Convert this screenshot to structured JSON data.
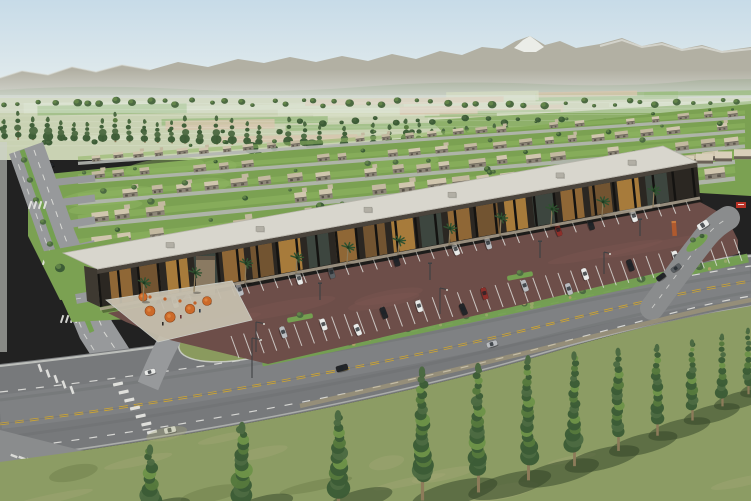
{
  "meta": {
    "title": "Aerial rendering of master-planned community",
    "description": "Photorealistic aerial 3D rendering of a desert-valley master-planned community: rows of flat-roofed single-story homes with lawns and trees, a single-story retail strip with covered walkway, palm trees and orange cafe umbrellas, an angled surface parking lot with cars, a curving arterial road with double-yellow centerline and crosswalks, a foreground lawn with a receding row of poplar trees, farm fields and a snow-capped mountain range in the distance under a hazy blue sky."
  },
  "palette": {
    "sky_top": "#c7dbe8",
    "sky_horizon": "#ecf1ee",
    "haze": "#e8edea",
    "mountain_far": "#b2b0a3",
    "snow": "#eef0ec",
    "foothill": "#9aa48d",
    "field_base": "#c9d2b3",
    "field_green": "#9cbd82",
    "field_pale": "#d5dcc2",
    "field_tan": "#d8c6ae",
    "field_bright": "#86ab61",
    "tree_dark": "#3c5c36",
    "tree_mid": "#4c6a42",
    "tree_light": "#6b8f4c",
    "trunk": "#8d7b5a",
    "lawn": "#7ba152",
    "lawn_light": "#8fb562",
    "street_minor": "#b4b7b2",
    "house_wall": "#8d8678",
    "house_roof_a": "#d0c6ae",
    "house_roof_b": "#c3b9a0",
    "house_edge": "#6e675c",
    "road": "#77797b",
    "road_light": "#8a8c8d",
    "road_pale": "#97999b",
    "sidewalk": "#cdd0ca",
    "lane_yellow": "#d2a62f",
    "lane_white": "#e8e8e4",
    "strip_roof": "#d8d6cd",
    "strip_fascia": "#4a443c",
    "strip_dark": "#2b2722",
    "post": "#141311",
    "storefront_a": "#9a6f38",
    "storefront_b": "#b5853e",
    "storefront_c": "#7a5a33",
    "tower": "#8a7a62",
    "plaza": "#c6bfae",
    "umbrella": "#cc6a2a",
    "palm": "#2f5230",
    "parking": "#6d4e49",
    "parking_light": "#7d5a52",
    "stripe": "#e2e3df",
    "island_green": "#74a050",
    "bed_green": "#8a9a5e",
    "car_white": "#e9eae8",
    "car_black": "#232528",
    "car_silver": "#b9bcc0",
    "car_gray": "#5a5f63",
    "car_red": "#8d2f2a",
    "median_green": "#74a050",
    "monument": "#b05a2e",
    "sign_red": "#b83227",
    "shop_far": "#d8cfba",
    "grass": "#8c9c64",
    "grass_light": "#a5a878",
    "grass_dark": "#61743f",
    "shadow": "#2f4226",
    "dirt": "#b3a478",
    "pole": "#3f4143"
  },
  "scene": {
    "sky": {
      "label": "hazy pale blue sky"
    },
    "mountains": {
      "label": "distant mountain range with one snow-capped peak",
      "snow_peak_present": true
    },
    "farmland": {
      "label": "patchwork of green and tan farm fields with rows of distant trees"
    },
    "mid_tree_row": {
      "label": "long row of slender poplar trees separating fields from housing"
    },
    "residential": {
      "label": "diagonal rows of beige flat-roofed single-story houses with lawns and round trees",
      "house_rows": 6
    },
    "left_streets": {
      "label": "boulevard with planted median, branch streets and crosswalks"
    },
    "retail_strip": {
      "label": "single-story retail strip, light flat roof, dark covered walkway with warm storefronts, palm trees in front",
      "palm_count": 11,
      "rooftop_units": 6,
      "corner_tower": true
    },
    "cafe_plaza": {
      "label": "outdoor dining plaza with orange umbrellas at strip's left end",
      "umbrella_count": 5
    },
    "parking_lot": {
      "label": "reddish asphalt lot with angled white stalls and parked cars",
      "approx_cars": 23
    },
    "main_road": {
      "label": "curving arterial road, double yellow centerline, white lane dashes, zebra crosswalks, a few moving cars"
    },
    "entry_drive": {
      "label": "right-side entry drive with planted median, orange monument and small red sign"
    },
    "foreground": {
      "label": "sunlit lawn with a receding row of tall poplars casting long shadows",
      "poplar_count": 12
    }
  }
}
